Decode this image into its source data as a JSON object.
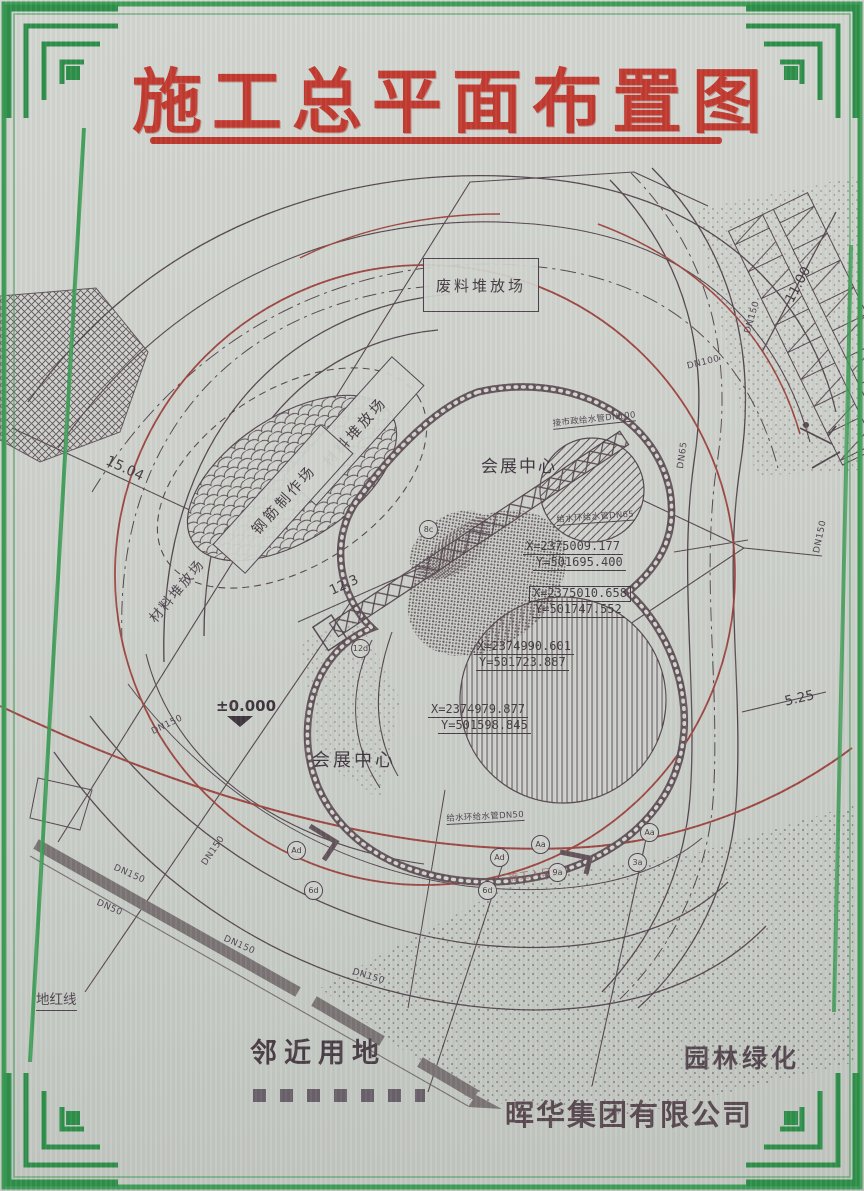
{
  "title": "施工总平面布置图",
  "company": "晖华集团有限公司",
  "labels": {
    "waste_yard": "废料堆放场",
    "material_yard_box": "材料堆放场",
    "rebar_yard": "钢筋制作场",
    "material_yard_text": "材料堆放场",
    "convention_center_top": "会展中心",
    "convention_center_bottom": "会展中心",
    "red_boundary": "地红线",
    "adjacent_land": "邻近用地",
    "landscape": "园林绿化",
    "site_entrance": "施工入口",
    "elevation": "±0.000"
  },
  "coordinates": [
    {
      "x": "X=2375009.177",
      "y": "Y=501695.400"
    },
    {
      "x": "X=2375010.658",
      "y": "Y=501747.552"
    },
    {
      "x": "X=2374990.601",
      "y": "Y=501723.887"
    },
    {
      "x": "X=2374979.877",
      "y": "Y=501598.845"
    }
  ],
  "dimensions": {
    "left": "15.04",
    "center": "12.3",
    "top_right": "11.00",
    "bottom_right": "5.25"
  },
  "pipes": [
    "DN150",
    "DN100",
    "DN65",
    "DN150",
    "DN150",
    "DN150",
    "DN150",
    "DN150",
    "DN150",
    "DN50"
  ],
  "utilities": [
    "接市政给水管DN100",
    "给水环给水管DN65",
    "给水环给水管DN50"
  ],
  "markers": [
    "8c",
    "12d",
    "Ad",
    "6d",
    "Ad",
    "6d",
    "Aa",
    "9a",
    "Aa",
    "3a"
  ],
  "colors": {
    "frame_green": "#3f9e58",
    "title_red": "#c23a30",
    "line_dark": "#564850",
    "crane_red": "#9e4742"
  }
}
